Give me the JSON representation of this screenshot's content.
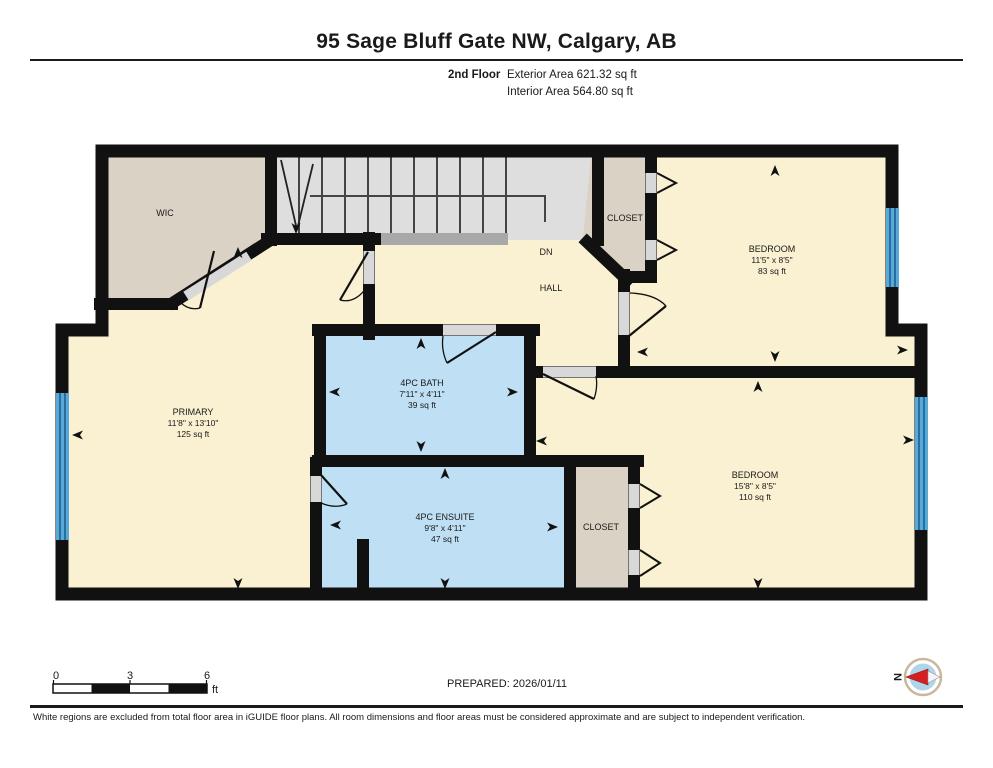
{
  "header": {
    "address": "95 Sage Bluff Gate NW, Calgary, AB",
    "floor_label": "2nd Floor",
    "exterior_area": "Exterior Area 621.32 sq ft",
    "interior_area": "Interior Area 564.80 sq ft"
  },
  "rooms": {
    "wic": {
      "name": "WIC"
    },
    "closet_top": {
      "name": "CLOSET"
    },
    "bedroom_top": {
      "name": "BEDROOM",
      "dims": "11'5\" x 8'5\"",
      "area": "83 sq ft"
    },
    "primary": {
      "name": "PRIMARY",
      "dims": "11'8\" x 13'10\"",
      "area": "125 sq ft"
    },
    "bath": {
      "name": "4PC BATH",
      "dims": "7'11\" x 4'11\"",
      "area": "39 sq ft"
    },
    "ensuite": {
      "name": "4PC ENSUITE",
      "dims": "9'8\" x 4'11\"",
      "area": "47 sq ft"
    },
    "closet_bottom": {
      "name": "CLOSET"
    },
    "bedroom_bottom": {
      "name": "BEDROOM",
      "dims": "15'8\" x 8'5\"",
      "area": "110 sq ft"
    },
    "hall": {
      "name": "HALL",
      "stairs_label": "DN"
    }
  },
  "footer": {
    "prepared": "PREPARED: 2026/01/11",
    "disclaimer": "White regions are excluded from total floor area in iGUIDE floor plans. All room dimensions and floor areas must be considered approximate and are subject to independent verification.",
    "scale": {
      "tick0": "0",
      "tick3": "3",
      "tick6": "6",
      "unit": "ft"
    },
    "compass": {
      "north_label": "N"
    }
  },
  "colors": {
    "room_cream": "#FAF0D2",
    "closet_tan": "#DAD2C4",
    "bath_blue": "#BFE0F4",
    "stairs_gray": "#DEDEDE",
    "wall_black": "#111111",
    "window_blue": "#58A8D8",
    "compass_red": "#D42020"
  }
}
